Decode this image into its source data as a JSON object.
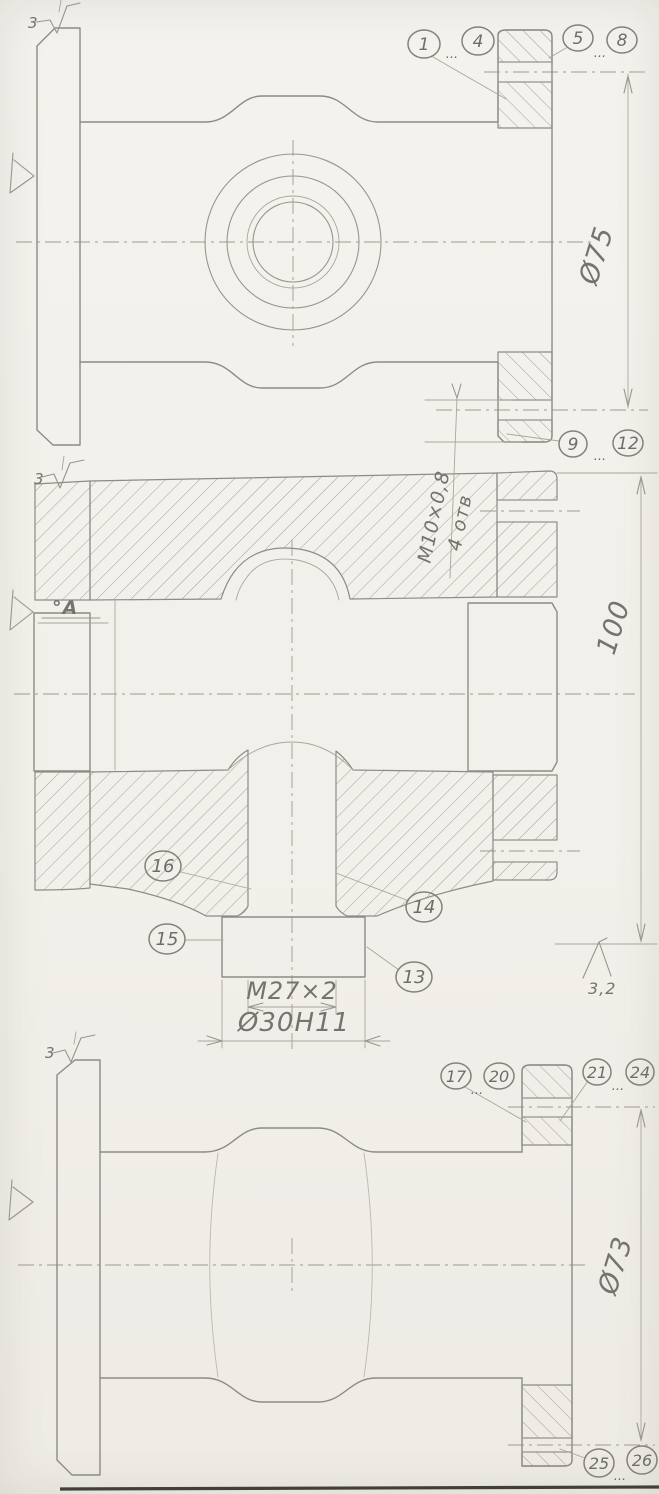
{
  "ellipsis": "...",
  "surface": {
    "rz_top": "3",
    "rz_mid": "3",
    "rz_bot": "3",
    "ra_value": "3,2"
  },
  "labels": {
    "datum_a": "°A"
  },
  "dims": {
    "top_bolt_circle": "Ø75",
    "mid_height": "100",
    "mid_thread": "M27×2",
    "mid_bore": "Ø30H11",
    "hole_thread": "M10×0,8",
    "hole_count": "4 отв",
    "bot_bolt_circle": "Ø73"
  },
  "balloons": {
    "b1": "1",
    "b4": "4",
    "b5": "5",
    "b8": "8",
    "b9": "9",
    "b12": "12",
    "b13": "13",
    "b14": "14",
    "b15": "15",
    "b16": "16",
    "b17": "17",
    "b20": "20",
    "b21": "21",
    "b24": "24",
    "b25": "25",
    "b26": "26"
  }
}
